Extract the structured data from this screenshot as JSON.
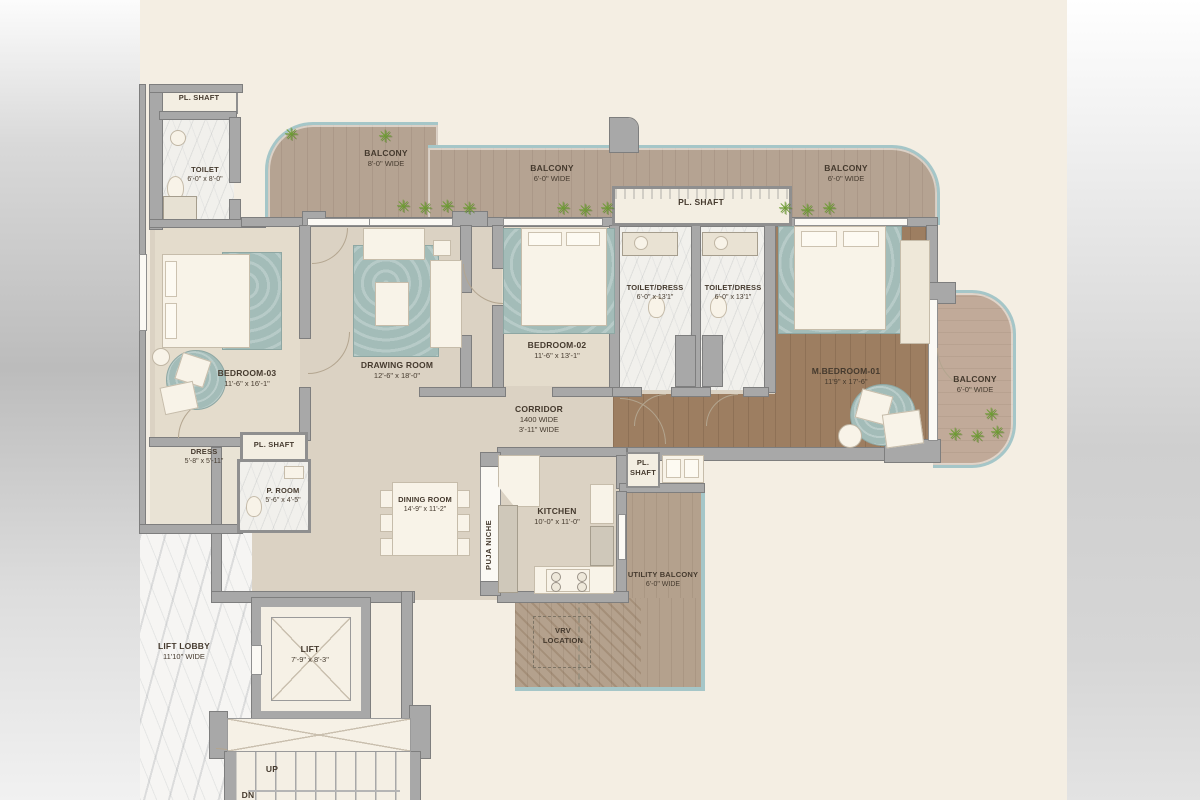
{
  "rooms": {
    "pl_shaft_topleft": {
      "name": "PL. SHAFT"
    },
    "toilet_topleft": {
      "name": "TOILET",
      "dims": "6'-0\" x 8'-0\""
    },
    "balcony_left": {
      "name": "BALCONY",
      "dims": "8'-0\" WIDE"
    },
    "balcony_mid": {
      "name": "BALCONY",
      "dims": "6'-0\" WIDE"
    },
    "pl_shaft_top": {
      "name": "PL. SHAFT"
    },
    "balcony_topright": {
      "name": "BALCONY",
      "dims": "6'-0\" WIDE"
    },
    "toilet_dress_left": {
      "name": "TOILET/DRESS",
      "dims": "6'-0\" x 13'1\""
    },
    "toilet_dress_right": {
      "name": "TOILET/DRESS",
      "dims": "6'-0\" x 13'1\""
    },
    "bedroom03": {
      "name": "BEDROOM-03",
      "dims": "11'-6\" x 16'-1\""
    },
    "drawing_room": {
      "name": "DRAWING ROOM",
      "dims": "12'-6\" x 18'-0\""
    },
    "bedroom02": {
      "name": "BEDROOM-02",
      "dims": "11'-6\" x 13'-1\""
    },
    "mbedroom01": {
      "name": "M.BEDROOM-01",
      "dims": "11'9\" x 17'-6\""
    },
    "balcony_right": {
      "name": "BALCONY",
      "dims": "6'-0\" WIDE"
    },
    "corridor": {
      "name": "CORRIDOR",
      "width_mm": "1400 WIDE",
      "dims": "3'-11\" WIDE"
    },
    "dress": {
      "name": "DRESS",
      "dims": "5'-8\" x 5'-11\""
    },
    "pl_shaft_mid": {
      "name": "PL. SHAFT"
    },
    "p_room": {
      "name": "P. ROOM",
      "dims": "5'-6\" x 4'-5\""
    },
    "dining_room": {
      "name": "DINING ROOM",
      "dims": "14'-9\" x 11'-2\""
    },
    "puja_niche": {
      "name": "PUJA NICHE"
    },
    "kitchen": {
      "name": "KITCHEN",
      "dims": "10'-0\" x 11'-0\""
    },
    "pl_shaft_kitchen": {
      "line1": "PL.",
      "line2": "SHAFT"
    },
    "utility_balcony": {
      "name": "UTILITY BALCONY",
      "dims": "6'-0\" WIDE"
    },
    "vrv": {
      "line1": "VRV",
      "line2": "LOCATION"
    },
    "lift_lobby": {
      "name": "LIFT LOBBY",
      "dims": "11'10\" WIDE"
    },
    "lift": {
      "name": "LIFT",
      "dims": "7'-9\" x 8'-3\""
    },
    "stairs": {
      "up": "UP",
      "dn": "DN"
    }
  },
  "icons": {
    "plant": "✳"
  },
  "colors": {
    "canvas_cream": "#f4eee3",
    "wall_gray": "#a8a8a8",
    "balcony_wood": "#b5a392",
    "master_wood": "#9d7e61",
    "glass_teal": "#a5c6c8",
    "rug_teal": "#a3bcb8",
    "marble": "#f1f0ec",
    "plant_green": "#6d9d32"
  }
}
